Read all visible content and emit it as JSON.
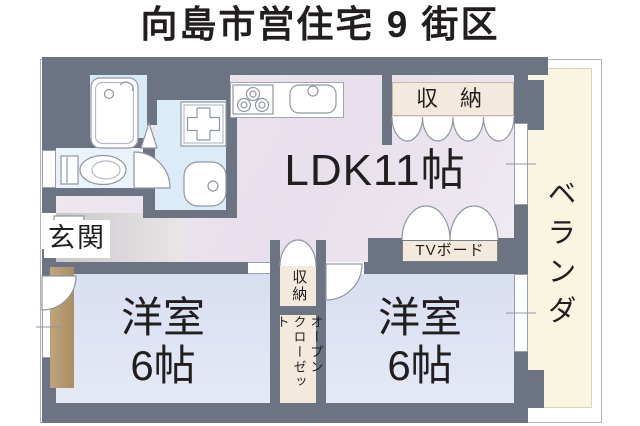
{
  "title": "向島市営住宅 9 街区",
  "rooms": {
    "ldk": "LDK11帖",
    "bedroom_left": "洋室\n6帖",
    "bedroom_right": "洋室\n6帖",
    "veranda": "ベランダ",
    "entrance": "玄関",
    "storage_top": "収 納",
    "storage_mid": "収納",
    "open_closet": "オープン\nクローゼット",
    "tv_board": "TVボード"
  },
  "icons": [
    "bathtub-icon",
    "bath-faucet-icon",
    "washing-machine-pan-icon",
    "washbasin-icon",
    "toilet-icon",
    "stove-burners-icon",
    "kitchen-sink-icon",
    "door-swing-icon",
    "folding-door-icon",
    "scallop-door-icon",
    "window-tick-icon",
    "bath-door-triangle-icon"
  ],
  "colors": {
    "wall": "#6c7383",
    "ldk_floor": "#ece4ee",
    "bedroom_floor": "#dde3f1",
    "bath_floor": "#d8e9f7",
    "veranda_floor": "#faf5e1",
    "closet_label_bg": "#f3eadd",
    "wood_accent": "#b3976e",
    "fixture_outline": "#9097a3",
    "text": "#221e1f"
  }
}
